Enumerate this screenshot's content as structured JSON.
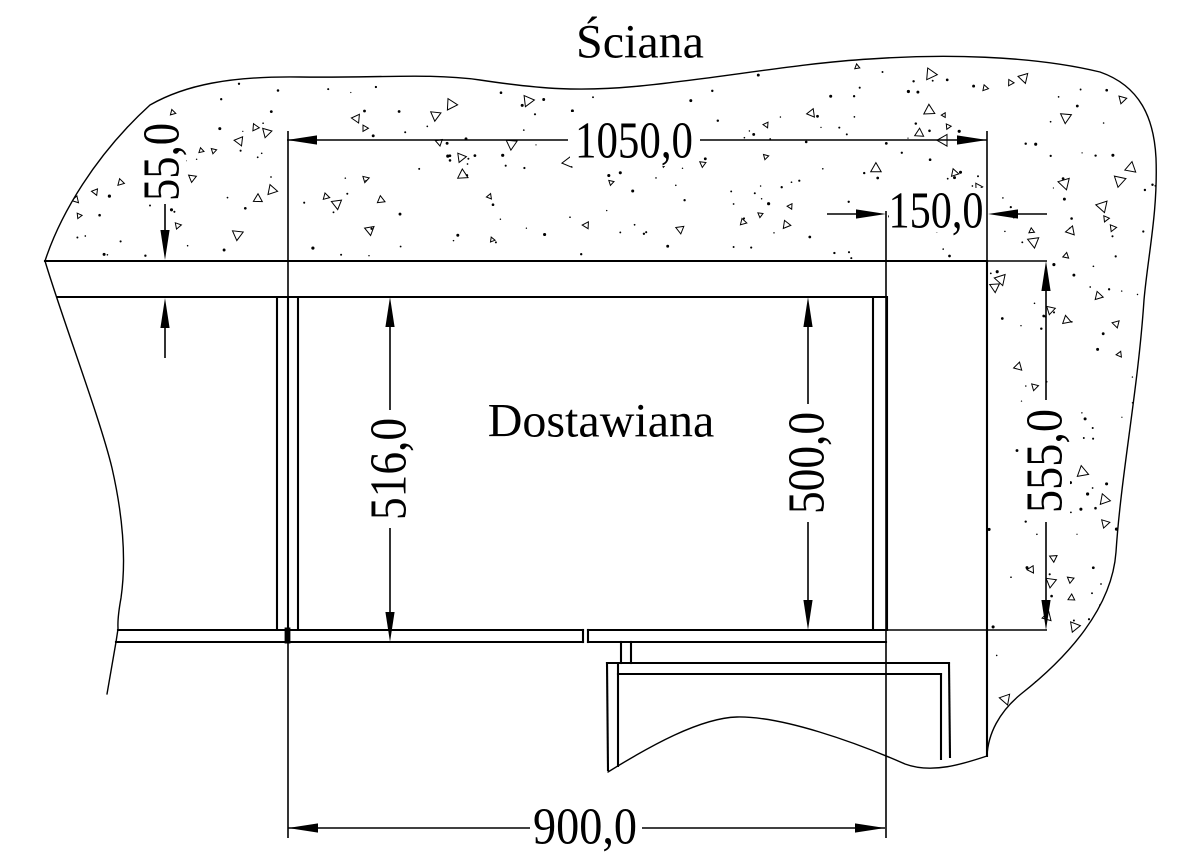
{
  "drawing": {
    "title": "Ściana",
    "component_label": "Dostawiana",
    "dimensions": {
      "overall_width": "1050,0",
      "wall_gap": "55,0",
      "side_clearance": "150,0",
      "worktop_depth": "516,0",
      "cabinet_depth": "500,0",
      "wall_to_front": "555,0",
      "cabinet_width": "900,0"
    },
    "colors": {
      "line": "#000000",
      "background": "#ffffff"
    }
  }
}
